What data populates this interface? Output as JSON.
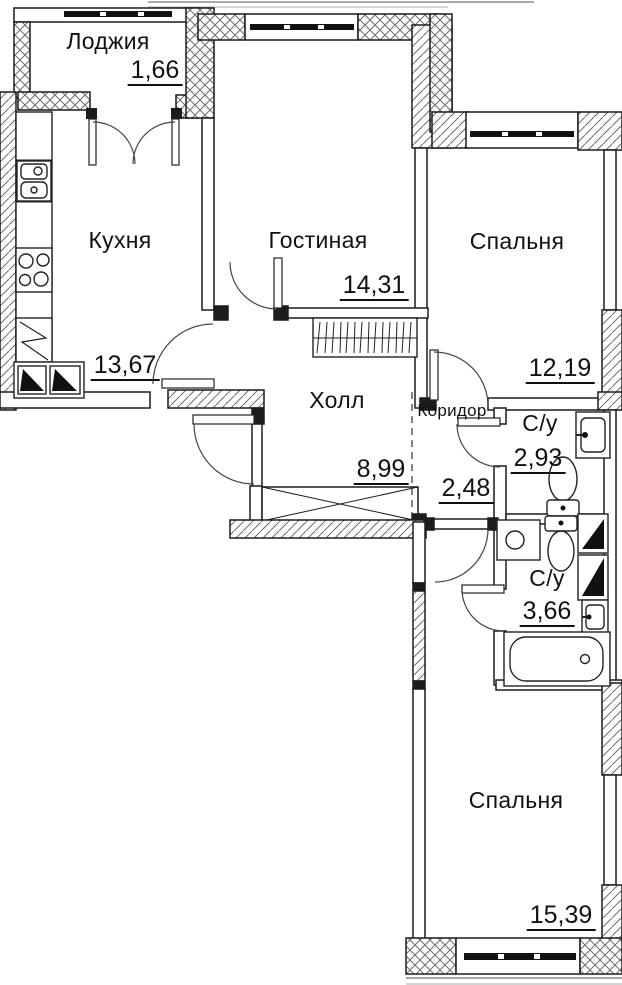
{
  "plan": {
    "type": "apartment-floor-plan",
    "language": "ru",
    "rooms": [
      {
        "name": "Лоджия",
        "area": "1,66"
      },
      {
        "name": "Кухня",
        "area": "13,67"
      },
      {
        "name": "Гостиная",
        "area": "14,31"
      },
      {
        "name": "Спальня",
        "area": "12,19"
      },
      {
        "name": "Холл",
        "area": "8,99"
      },
      {
        "name": "Коридор",
        "area": "2,48"
      },
      {
        "name": "С/у",
        "area": "2,93"
      },
      {
        "name": "С/у",
        "area": "3,66"
      },
      {
        "name": "Спальня",
        "area": "15,39"
      }
    ],
    "fixtures": [
      "kitchen-sink",
      "stove",
      "refrigerator",
      "vent-shaft",
      "wardrobe",
      "toilet",
      "wall-basin",
      "washing-machine",
      "bathtub",
      "shaft-box"
    ],
    "colors": {
      "wall_line": "#1c1c1c",
      "hatch": "#6e6e6e",
      "background": "#ffffff",
      "outline": "#a8a8a8",
      "text": "#111111"
    }
  }
}
